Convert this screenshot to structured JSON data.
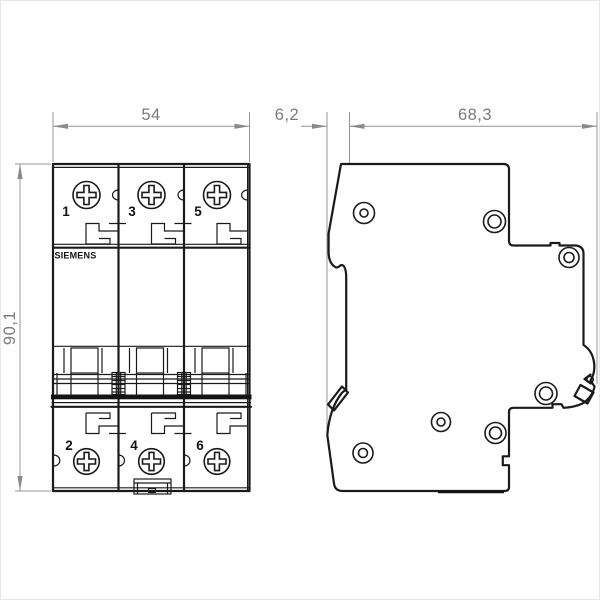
{
  "drawing": {
    "brand": "SIEMENS",
    "dimension_labels": {
      "front_width": "54",
      "side_offset": "6,2",
      "side_depth": "68,3",
      "front_height": "90,1"
    },
    "front_view": {
      "top_terminals": [
        "1",
        "3",
        "5"
      ],
      "bottom_terminals": [
        "2",
        "4",
        "6"
      ]
    },
    "colors": {
      "outline": "#1a1a1a",
      "dimension_line": "#949494",
      "dimension_text": "#7b7b7b",
      "background": "#ffffff"
    }
  }
}
